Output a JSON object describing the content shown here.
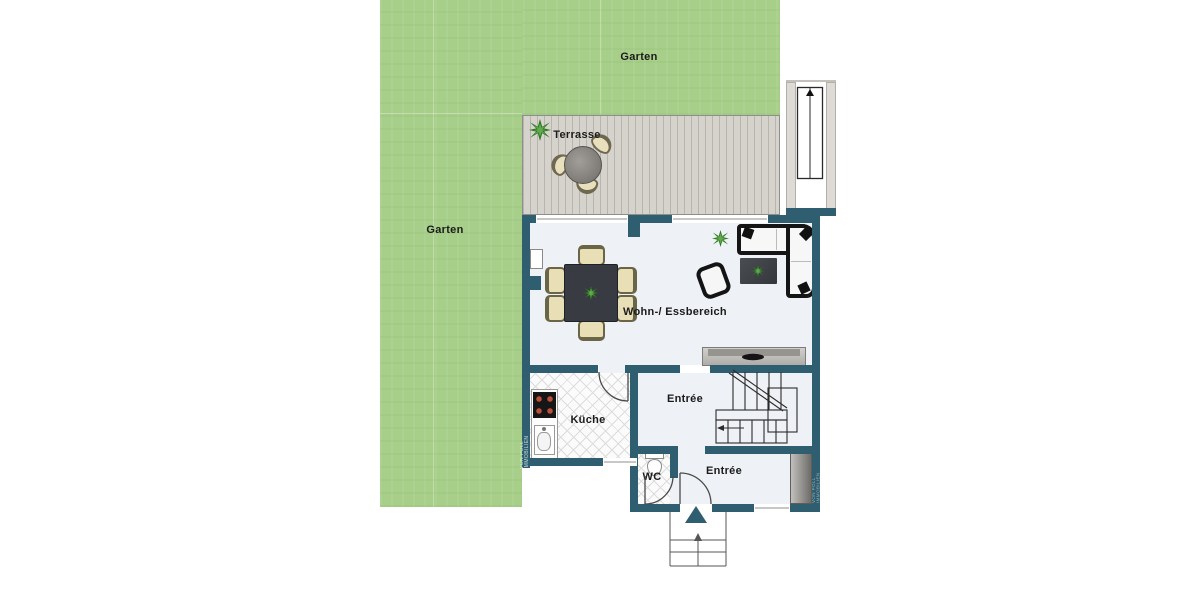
{
  "rooms": {
    "garden_top": {
      "label": "Garten"
    },
    "garden_left": {
      "label": "Garten"
    },
    "terrace": {
      "label": "Terrasse"
    },
    "living_dining": {
      "label": "Wohn-/ Essbereich"
    },
    "kitchen": {
      "label": "Küche"
    },
    "hall_upper": {
      "label": "Entrée"
    },
    "wc": {
      "label": "WC"
    },
    "hall_lower": {
      "label": "Entrée"
    }
  },
  "watermark": {
    "left": "VON POLL IMMOBILIEN",
    "right": "VON POLL IMMOBILIEN"
  },
  "colors": {
    "background": "#ffffff",
    "garden": "#a7cf8a",
    "terrace_deck": "#d6d2cc",
    "wall": "#2e5e70",
    "floor": "#eef1f5",
    "tile_line": "#dcdcdc",
    "furniture_beige": "#e9dfb6",
    "sofa_frame": "#151515",
    "plant_green": "#2e7a22",
    "stair_line": "#2b2b2b"
  }
}
